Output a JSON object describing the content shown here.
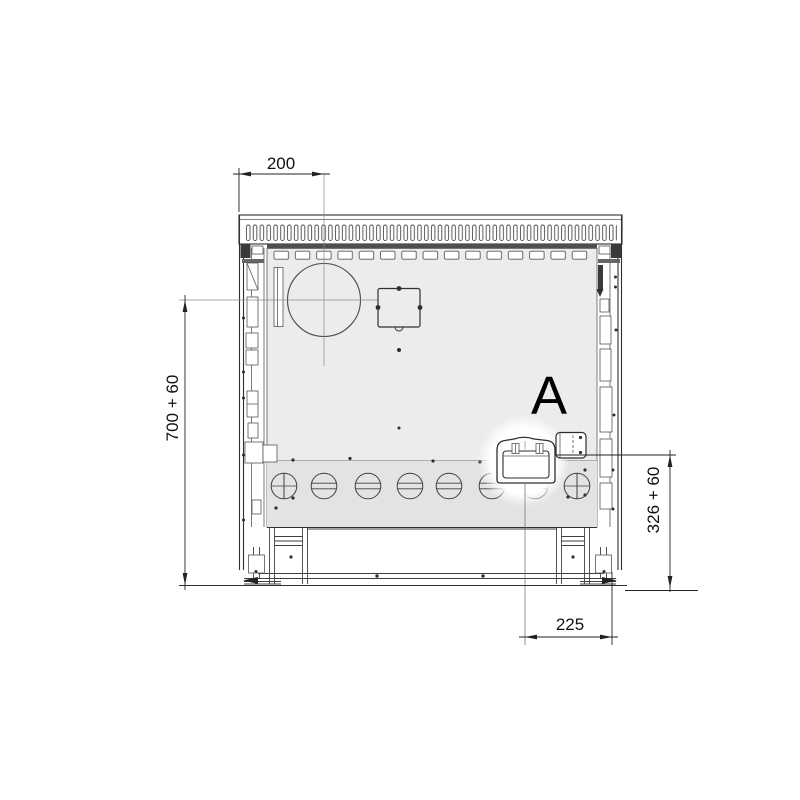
{
  "drawing": {
    "dimensions": {
      "top": "200",
      "left": "700 + 60",
      "right": "326 + 60",
      "bottom": "225"
    },
    "detail_marker": "A"
  },
  "colors": {
    "background": "#ffffff",
    "line": "#2f2f2f",
    "panel": "#ececec",
    "panel_lower": "#e3e3e3",
    "dark_bar": "#4f4f4f",
    "centerline": "#8a8a8a",
    "dimension_text": "#111111"
  }
}
